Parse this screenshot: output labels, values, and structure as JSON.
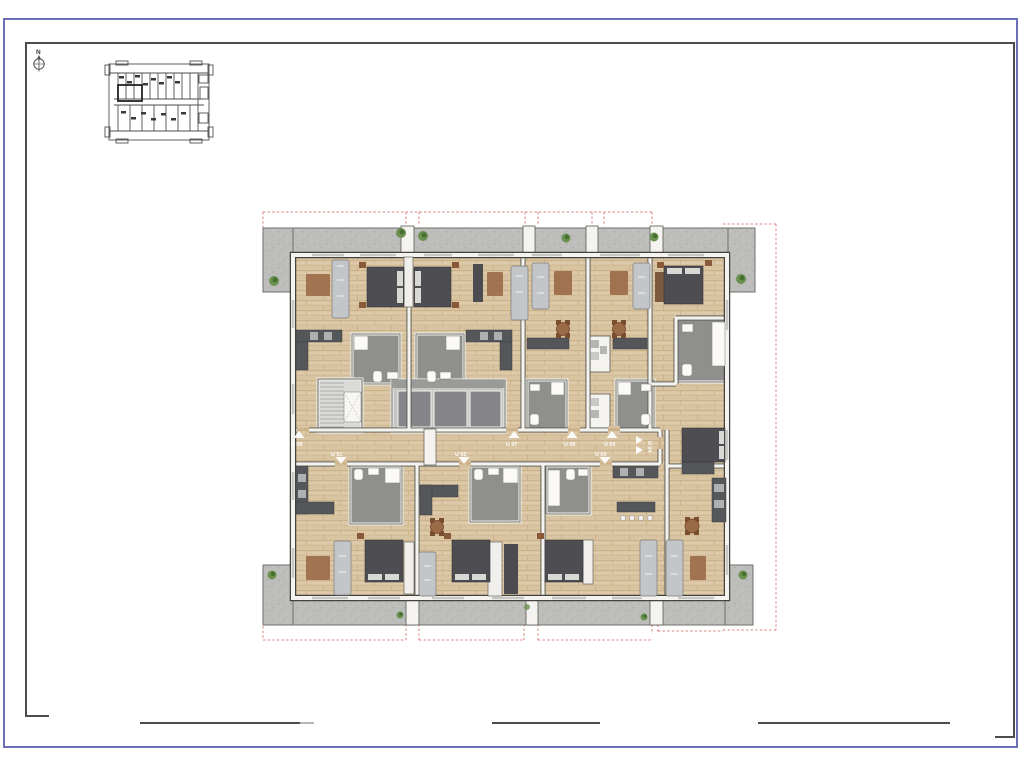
{
  "page": {
    "type": "architectural-floor-plan-sheet",
    "background": "#ffffff",
    "border_color": "#6b6fb6",
    "frame_line_color": "#4c4c4a"
  },
  "north": {
    "label": "N",
    "icon": "compass-north-icon"
  },
  "key_plan": {
    "icon": "mini-floor-plan"
  },
  "plan": {
    "units": [
      {
        "label": "U 08",
        "entry": "up"
      },
      {
        "label": "U 07",
        "entry": "up"
      },
      {
        "label": "U 06",
        "entry": "up"
      },
      {
        "label": "U 05",
        "entry": "up"
      },
      {
        "label": "U 01",
        "entry": "down"
      },
      {
        "label": "U 02",
        "entry": "down"
      },
      {
        "label": "U 03",
        "entry": "down"
      },
      {
        "label": "U 04",
        "entry": "right"
      }
    ],
    "icons": {
      "tree": "tree-icon",
      "entry_arrow": "triangle-arrow-icon",
      "stairs": "stair-flight",
      "elevators": "elevator-bank"
    },
    "colors": {
      "setback_dashed": "#d97272",
      "wood_floor": "#d9c4a2",
      "terrace_concrete": "#bdbdbb",
      "wall_white": "#f4f3ef",
      "wall_edge": "#55544e",
      "furniture_dark": "#515156",
      "sofa_gray": "#c3c6c8",
      "bath_floor": "#8f8f8d",
      "wood_brown": "#9b6a47",
      "plant_green": "#5d8744",
      "stair_gray": "#dadad8",
      "elevator_gray": "#86868a",
      "label_white": "#ffffff"
    }
  }
}
